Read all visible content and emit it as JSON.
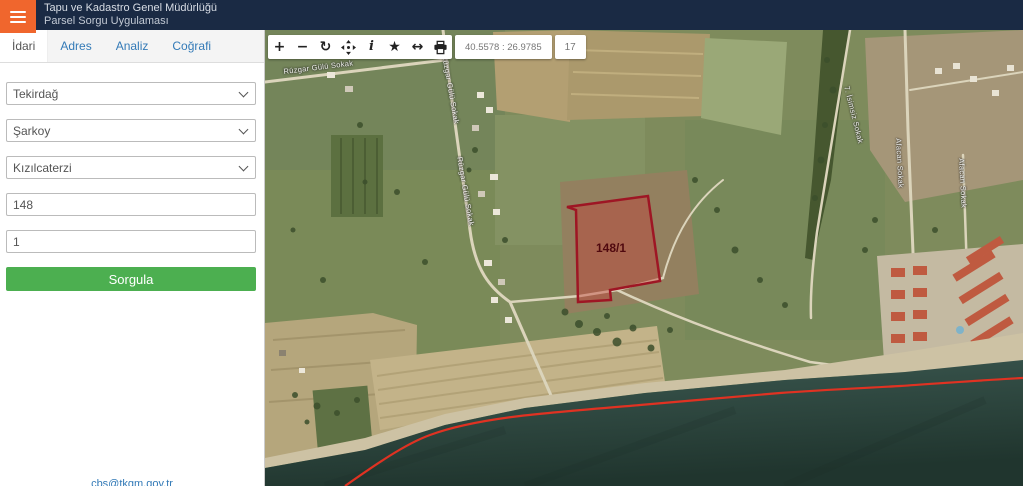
{
  "header": {
    "title_line1": "Tapu ve Kadastro Genel Müdürlüğü",
    "title_line2": "Parsel Sorgu Uygulaması"
  },
  "sidebar": {
    "tabs": [
      {
        "label": "İdari",
        "active": true
      },
      {
        "label": "Adres",
        "active": false
      },
      {
        "label": "Analiz",
        "active": false
      },
      {
        "label": "Coğrafi",
        "active": false
      }
    ],
    "form": {
      "province": "Tekirdağ",
      "district": "Şarkoy",
      "neighborhood": "Kızılcaterzi",
      "block_no": "148",
      "parcel_no": "1",
      "submit_label": "Sorgula"
    },
    "footer_link": "cbs@tkgm.gov.tr"
  },
  "map": {
    "toolbar": {
      "buttons": [
        {
          "name": "zoom-in-icon",
          "glyph": "+"
        },
        {
          "name": "zoom-out-icon",
          "glyph": "−"
        },
        {
          "name": "refresh-icon",
          "glyph": "↻"
        },
        {
          "name": "pan-icon"
        },
        {
          "name": "info-icon",
          "glyph": "i"
        },
        {
          "name": "favorites-icon",
          "glyph": "★"
        },
        {
          "name": "measure-icon",
          "glyph": "↔"
        },
        {
          "name": "print-icon"
        }
      ],
      "coordinates": "40.5578 : 26.9785",
      "zoom_level": "17"
    },
    "parcel_label": "148/1",
    "street_labels": [
      "Rüzgar Gülü Sokak",
      "Rüzgar Gülü Sokak",
      "Rüzgar Gülü Sokak",
      "7. İsimsiz Sokak",
      "Afacan Sokak",
      "Afacan Sokak"
    ]
  },
  "colors": {
    "accent_orange": "#f0662d",
    "header_bg": "#1a2a44",
    "link_blue": "#337ab7",
    "button_green": "#4caf50",
    "parcel_stroke": "#9e1624",
    "parcel_fill": "rgba(195,62,55,0.42)",
    "parcel_label_color": "#50090f",
    "coastline_red": "#e03222"
  }
}
